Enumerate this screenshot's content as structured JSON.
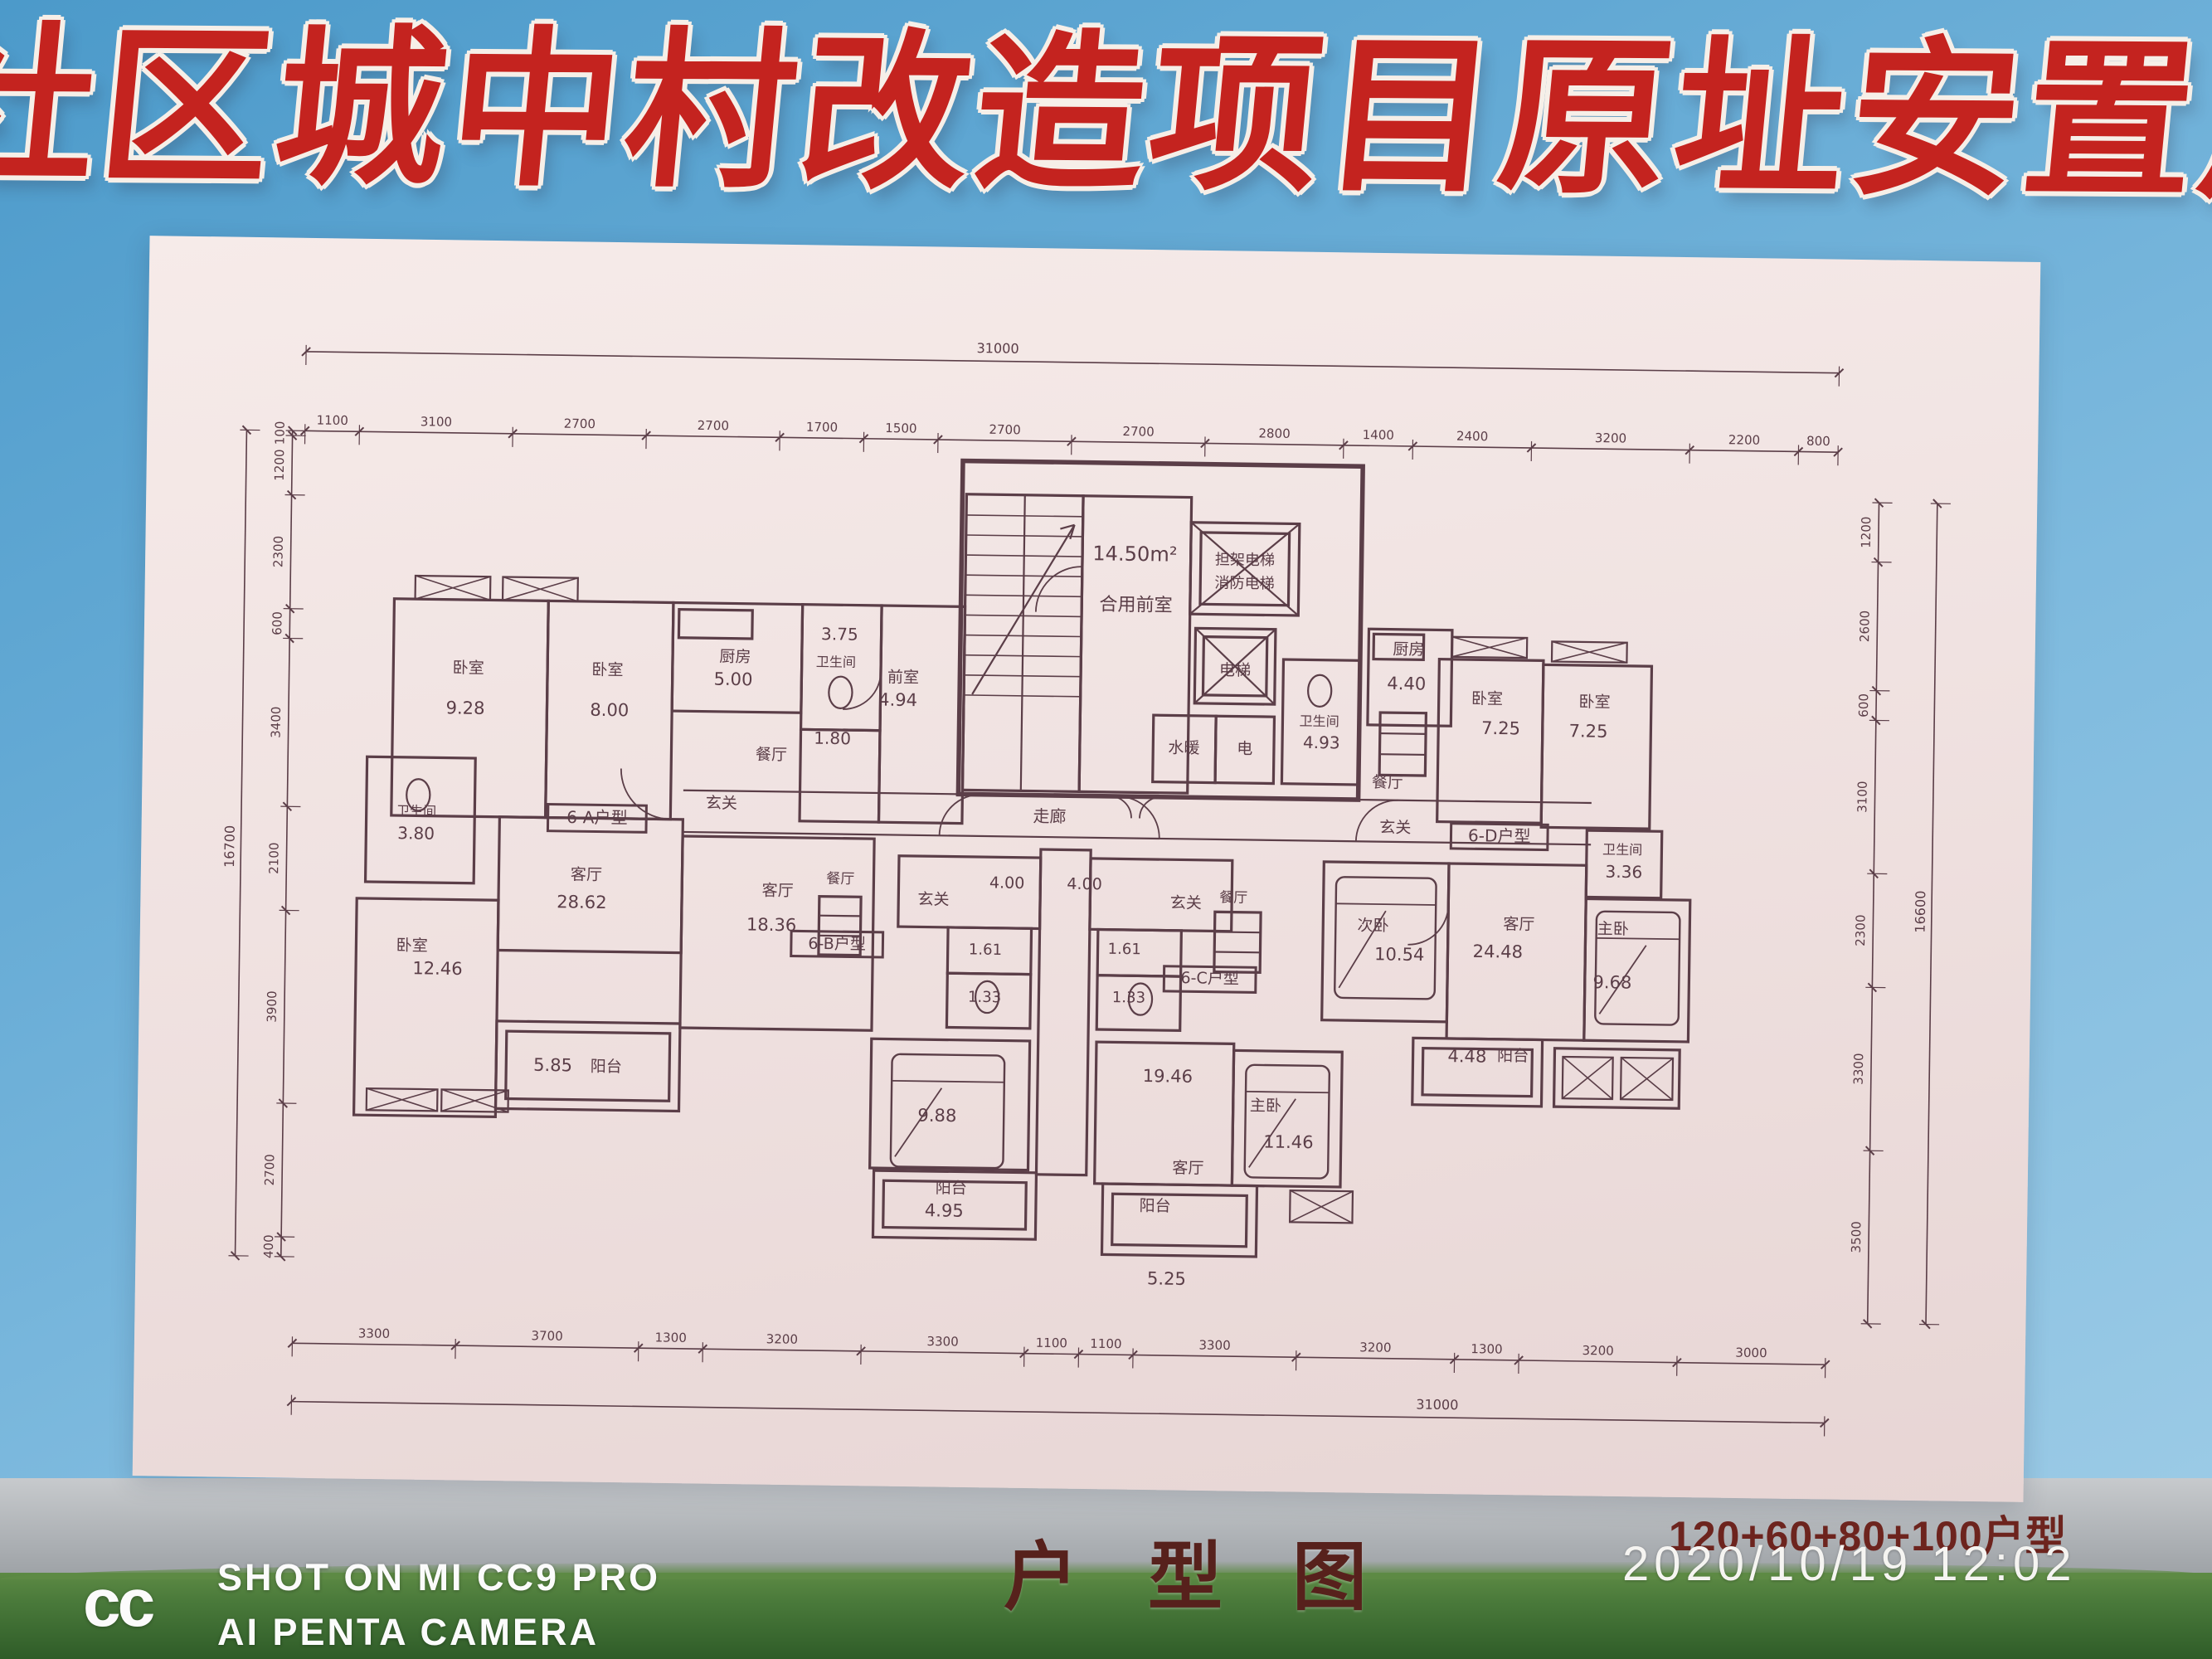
{
  "billboard": {
    "title": "社区城中村改造项目原址安置户型图"
  },
  "footer": {
    "watermark_logo": "cc",
    "watermark_line1": "SHOT ON MI CC9 PRO",
    "watermark_line2": "AI PENTA CAMERA",
    "caption": "户型图",
    "unit_mix": "120+60+80+100户型",
    "timestamp": "2020/10/19  12:02"
  },
  "plan": {
    "dims": {
      "top_total": "31000",
      "top": [
        "1100",
        "3100",
        "2700",
        "2700",
        "1700",
        "1500",
        "2700",
        "2700",
        "2800",
        "1400",
        "2400",
        "3200",
        "2200",
        "800"
      ],
      "bottom": [
        "3300",
        "3700",
        "1300",
        "3200",
        "3300",
        "1100",
        "1100",
        "3300",
        "3200",
        "1300",
        "3200",
        "3000"
      ],
      "bottom_total": "31000",
      "left": [
        "100",
        "1200",
        "2300",
        "600",
        "3400",
        "2100",
        "3900",
        "2700",
        "400"
      ],
      "left_total": "16700",
      "right": [
        "1200",
        "2600",
        "600",
        "3100",
        "2300",
        "3300",
        "3500"
      ],
      "right_total": "16600"
    },
    "core": {
      "area": "14.50m²",
      "lobby": "合用前室",
      "elevator1a": "担架电梯",
      "elevator1b": "消防电梯",
      "elevator2": "电梯",
      "utility_water": "水暖",
      "utility_elec": "电",
      "corridor": "走廊"
    },
    "units": {
      "a": {
        "name": "6-A户型",
        "bedroom1": "卧室",
        "bedroom1_area": "9.28",
        "bedroom2": "卧室",
        "bedroom2_area": "8.00",
        "kitchen": "厨房",
        "kitchen_area": "5.00",
        "bath1": "卫生间",
        "bath1_area": "3.75",
        "shower_area": "1.80",
        "foyer_room": "前室",
        "foyer_room_area": "4.94",
        "dining": "餐厅",
        "entry": "玄关",
        "bath2": "卫生间",
        "bath2_area": "3.80",
        "living": "客厅",
        "living_area": "28.62",
        "bedroom3": "卧室",
        "bedroom3_area": "12.46",
        "balcony": "阳台",
        "balcony_area": "5.85"
      },
      "b": {
        "name": "6-B户型",
        "living": "客厅",
        "living_area": "18.36",
        "dining": "餐厅",
        "entry": "玄关",
        "entry_area": "4.00",
        "bath1_area": "1.61",
        "bath2_area": "1.33",
        "bedroom_area": "9.88",
        "balcony": "阳台",
        "balcony_area": "4.95"
      },
      "c": {
        "name": "6-C户型",
        "entry": "玄关",
        "entry_area": "4.00",
        "dining": "餐厅",
        "bath1_area": "1.61",
        "bath2_area": "1.33",
        "living": "客厅",
        "living_area": "19.46",
        "master": "主卧",
        "master_area": "11.46",
        "balcony": "阳台",
        "balcony_area": "5.25"
      },
      "d": {
        "name": "6-D户型",
        "kitchen": "厨房",
        "kitchen_area": "4.40",
        "bath1": "卫生间",
        "bath1_area": "4.93",
        "dining": "餐厅",
        "entry": "玄关",
        "bedroom1": "卧室",
        "bedroom1_area": "7.25",
        "bedroom2": "卧室",
        "bedroom2_area": "7.25",
        "bath2": "卫生间",
        "bath2_area": "3.36",
        "second": "次卧",
        "second_area": "10.54",
        "living": "客厅",
        "living_area": "24.48",
        "master": "主卧",
        "master_area": "9.68",
        "balcony": "阳台",
        "balcony_area": "4.48"
      }
    }
  }
}
